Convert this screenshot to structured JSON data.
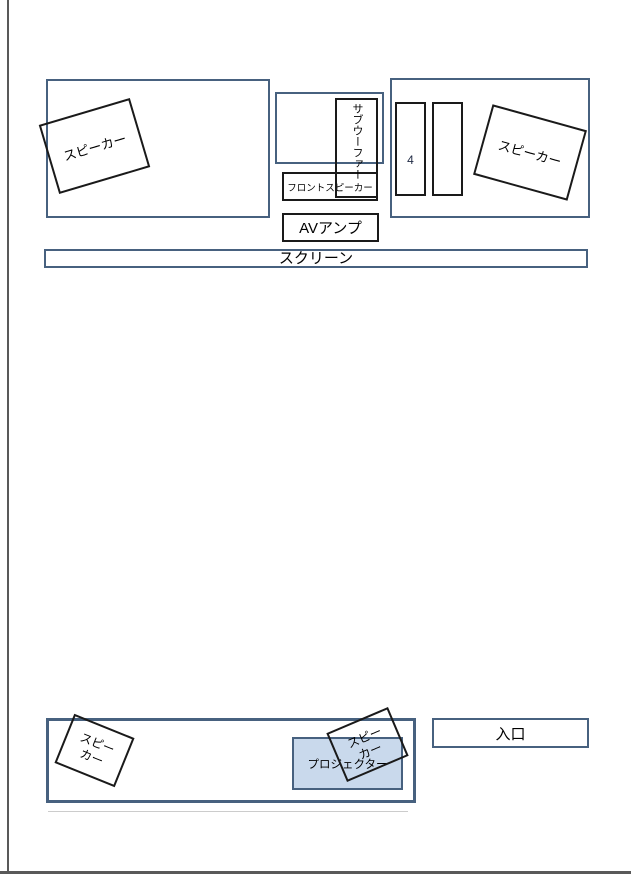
{
  "colors": {
    "page_border": "#595959",
    "blue_border": "#47617f",
    "black_border": "#1a1a1a",
    "projector_fill": "#c9d9ec",
    "faint_line": "#cccccc",
    "text": "#000000"
  },
  "rooms": {
    "top_left": {
      "speaker_label": "スピーカー"
    },
    "top_right": {
      "speaker_label": "スピーカー",
      "rack1_label": "4",
      "rack2_label": ""
    },
    "bottom": {
      "speaker_left_label": "スピー\nカー",
      "speaker_center_label": "スピー\nカー"
    }
  },
  "equipment": {
    "subwoofer_label": "サブウーファー",
    "front_speaker_label": "フロントスピーカー",
    "av_amp_label": "AVアンプ",
    "screen_label": "スクリーン",
    "projector_label": "プロジェクター",
    "entrance_label": "入口"
  }
}
